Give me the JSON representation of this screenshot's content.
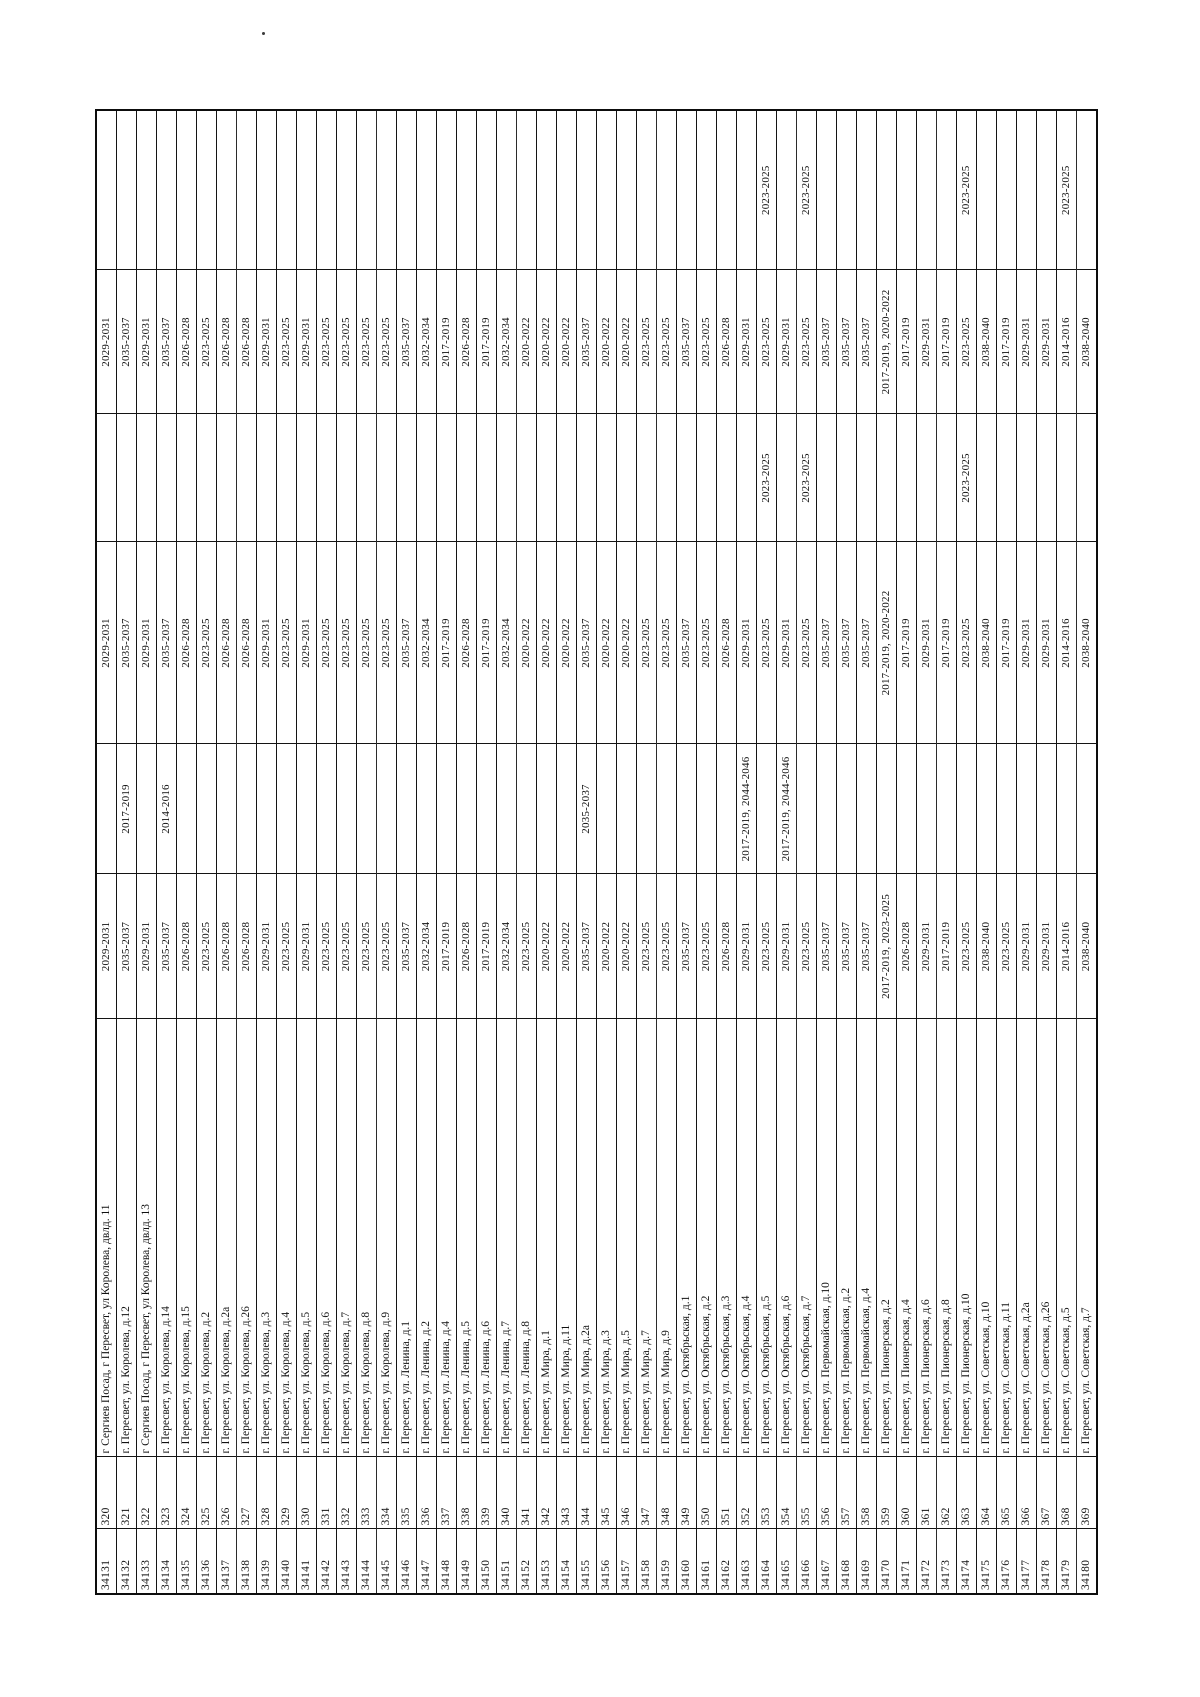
{
  "page": {
    "background": "#ffffff",
    "ink_color": "#111111",
    "artifact_dot": ".",
    "orientation_note_rows": "320-369",
    "orientation_note_ids": "34131-34180"
  },
  "table": {
    "orientation": "rotated-90-counterclockwise",
    "column_keys": [
      "id",
      "num",
      "address",
      "period_1",
      "period_2",
      "period_3",
      "period_4",
      "period_5",
      "period_6"
    ],
    "rows": [
      {
        "id": "34131",
        "num": "320",
        "address": "г Сергиев Посад, г Пересвет, ул Королева, двлд. 11",
        "periods": [
          "2029-2031",
          "",
          "2029-2031",
          "",
          "2029-2031",
          ""
        ]
      },
      {
        "id": "34132",
        "num": "321",
        "address": "г. Пересвет, ул. Королева, д.12",
        "periods": [
          "2035-2037",
          "2017-2019",
          "2035-2037",
          "",
          "2035-2037",
          ""
        ]
      },
      {
        "id": "34133",
        "num": "322",
        "address": "г Сергиев Посад, г Пересвет, ул Королева, двлд. 13",
        "periods": [
          "2029-2031",
          "",
          "2029-2031",
          "",
          "2029-2031",
          ""
        ]
      },
      {
        "id": "34134",
        "num": "323",
        "address": "г. Пересвет, ул. Королева, д.14",
        "periods": [
          "2035-2037",
          "2014-2016",
          "2035-2037",
          "",
          "2035-2037",
          ""
        ]
      },
      {
        "id": "34135",
        "num": "324",
        "address": "г. Пересвет, ул. Королева, д.15",
        "periods": [
          "2026-2028",
          "",
          "2026-2028",
          "",
          "2026-2028",
          ""
        ]
      },
      {
        "id": "34136",
        "num": "325",
        "address": "г. Пересвет, ул. Королева, д.2",
        "periods": [
          "2023-2025",
          "",
          "2023-2025",
          "",
          "2023-2025",
          ""
        ]
      },
      {
        "id": "34137",
        "num": "326",
        "address": "г. Пересвет, ул. Королева, д.2а",
        "periods": [
          "2026-2028",
          "",
          "2026-2028",
          "",
          "2026-2028",
          ""
        ]
      },
      {
        "id": "34138",
        "num": "327",
        "address": "г. Пересвет, ул. Королева, д.26",
        "periods": [
          "2026-2028",
          "",
          "2026-2028",
          "",
          "2026-2028",
          ""
        ]
      },
      {
        "id": "34139",
        "num": "328",
        "address": "г. Пересвет, ул. Королева, д.3",
        "periods": [
          "2029-2031",
          "",
          "2029-2031",
          "",
          "2029-2031",
          ""
        ]
      },
      {
        "id": "34140",
        "num": "329",
        "address": "г. Пересвет, ул. Королева, д.4",
        "periods": [
          "2023-2025",
          "",
          "2023-2025",
          "",
          "2023-2025",
          ""
        ]
      },
      {
        "id": "34141",
        "num": "330",
        "address": "г. Пересвет, ул. Королева, д.5",
        "periods": [
          "2029-2031",
          "",
          "2029-2031",
          "",
          "2029-2031",
          ""
        ]
      },
      {
        "id": "34142",
        "num": "331",
        "address": "г. Пересвет, ул. Королева, д.6",
        "periods": [
          "2023-2025",
          "",
          "2023-2025",
          "",
          "2023-2025",
          ""
        ]
      },
      {
        "id": "34143",
        "num": "332",
        "address": "г. Пересвет, ул. Королева, д.7",
        "periods": [
          "2023-2025",
          "",
          "2023-2025",
          "",
          "2023-2025",
          ""
        ]
      },
      {
        "id": "34144",
        "num": "333",
        "address": "г. Пересвет, ул. Королева, д.8",
        "periods": [
          "2023-2025",
          "",
          "2023-2025",
          "",
          "2023-2025",
          ""
        ]
      },
      {
        "id": "34145",
        "num": "334",
        "address": "г. Пересвет, ул. Королева, д.9",
        "periods": [
          "2023-2025",
          "",
          "2023-2025",
          "",
          "2023-2025",
          ""
        ]
      },
      {
        "id": "34146",
        "num": "335",
        "address": "г. Пересвет, ул. Ленина, д.1",
        "periods": [
          "2035-2037",
          "",
          "2035-2037",
          "",
          "2035-2037",
          ""
        ]
      },
      {
        "id": "34147",
        "num": "336",
        "address": "г. Пересвет, ул. Ленина, д.2",
        "periods": [
          "2032-2034",
          "",
          "2032-2034",
          "",
          "2032-2034",
          ""
        ]
      },
      {
        "id": "34148",
        "num": "337",
        "address": "г. Пересвет, ул. Ленина, д.4",
        "periods": [
          "2017-2019",
          "",
          "2017-2019",
          "",
          "2017-2019",
          ""
        ]
      },
      {
        "id": "34149",
        "num": "338",
        "address": "г. Пересвет, ул. Ленина, д.5",
        "periods": [
          "2026-2028",
          "",
          "2026-2028",
          "",
          "2026-2028",
          ""
        ]
      },
      {
        "id": "34150",
        "num": "339",
        "address": "г. Пересвет, ул. Ленина, д.6",
        "periods": [
          "2017-2019",
          "",
          "2017-2019",
          "",
          "2017-2019",
          ""
        ]
      },
      {
        "id": "34151",
        "num": "340",
        "address": "г. Пересвет, ул. Ленина, д.7",
        "periods": [
          "2032-2034",
          "",
          "2032-2034",
          "",
          "2032-2034",
          ""
        ]
      },
      {
        "id": "34152",
        "num": "341",
        "address": "г. Пересвет, ул. Ленина, д.8",
        "periods": [
          "2023-2025",
          "",
          "2020-2022",
          "",
          "2020-2022",
          ""
        ]
      },
      {
        "id": "34153",
        "num": "342",
        "address": "г. Пересвет, ул. Мира, д.1",
        "periods": [
          "2020-2022",
          "",
          "2020-2022",
          "",
          "2020-2022",
          ""
        ]
      },
      {
        "id": "34154",
        "num": "343",
        "address": "г. Пересвет, ул. Мира, д.11",
        "periods": [
          "2020-2022",
          "",
          "2020-2022",
          "",
          "2020-2022",
          ""
        ]
      },
      {
        "id": "34155",
        "num": "344",
        "address": "г. Пересвет, ул. Мира, д.2а",
        "periods": [
          "2035-2037",
          "2035-2037",
          "2035-2037",
          "",
          "2035-2037",
          ""
        ]
      },
      {
        "id": "34156",
        "num": "345",
        "address": "г. Пересвет, ул. Мира, д.3",
        "periods": [
          "2020-2022",
          "",
          "2020-2022",
          "",
          "2020-2022",
          ""
        ]
      },
      {
        "id": "34157",
        "num": "346",
        "address": "г. Пересвет, ул. Мира, д.5",
        "periods": [
          "2020-2022",
          "",
          "2020-2022",
          "",
          "2020-2022",
          ""
        ]
      },
      {
        "id": "34158",
        "num": "347",
        "address": "г. Пересвет, ул. Мира, д.7",
        "periods": [
          "2023-2025",
          "",
          "2023-2025",
          "",
          "2023-2025",
          ""
        ]
      },
      {
        "id": "34159",
        "num": "348",
        "address": "г. Пересвет, ул. Мира, д.9",
        "periods": [
          "2023-2025",
          "",
          "2023-2025",
          "",
          "2023-2025",
          ""
        ]
      },
      {
        "id": "34160",
        "num": "349",
        "address": "г. Пересвет, ул. Октябрьская, д.1",
        "periods": [
          "2035-2037",
          "",
          "2035-2037",
          "",
          "2035-2037",
          ""
        ]
      },
      {
        "id": "34161",
        "num": "350",
        "address": "г. Пересвет, ул. Октябрьская, д.2",
        "periods": [
          "2023-2025",
          "",
          "2023-2025",
          "",
          "2023-2025",
          ""
        ]
      },
      {
        "id": "34162",
        "num": "351",
        "address": "г. Пересвет, ул. Октябрьская, д.3",
        "periods": [
          "2026-2028",
          "",
          "2026-2028",
          "",
          "2026-2028",
          ""
        ]
      },
      {
        "id": "34163",
        "num": "352",
        "address": "г. Пересвет, ул. Октябрьская, д.4",
        "periods": [
          "2029-2031",
          "2017-2019, 2044-2046",
          "2029-2031",
          "",
          "2029-2031",
          ""
        ]
      },
      {
        "id": "34164",
        "num": "353",
        "address": "г. Пересвет, ул. Октябрьская, д.5",
        "periods": [
          "2023-2025",
          "",
          "2023-2025",
          "2023-2025",
          "2023-2025",
          "2023-2025"
        ]
      },
      {
        "id": "34165",
        "num": "354",
        "address": "г. Пересвет, ул. Октябрьская, д.6",
        "periods": [
          "2029-2031",
          "2017-2019, 2044-2046",
          "2029-2031",
          "",
          "2029-2031",
          ""
        ]
      },
      {
        "id": "34166",
        "num": "355",
        "address": "г. Пересвет, ул. Октябрьская, д.7",
        "periods": [
          "2023-2025",
          "",
          "2023-2025",
          "2023-2025",
          "2023-2025",
          "2023-2025"
        ]
      },
      {
        "id": "34167",
        "num": "356",
        "address": "г. Пересвет, ул. Первомайская, д.10",
        "periods": [
          "2035-2037",
          "",
          "2035-2037",
          "",
          "2035-2037",
          ""
        ]
      },
      {
        "id": "34168",
        "num": "357",
        "address": "г. Пересвет, ул. Первомайская, д.2",
        "periods": [
          "2035-2037",
          "",
          "2035-2037",
          "",
          "2035-2037",
          ""
        ]
      },
      {
        "id": "34169",
        "num": "358",
        "address": "г. Пересвет, ул. Первомайская, д.4",
        "periods": [
          "2035-2037",
          "",
          "2035-2037",
          "",
          "2035-2037",
          ""
        ]
      },
      {
        "id": "34170",
        "num": "359",
        "address": "г. Пересвет, ул. Пионерская, д.2",
        "periods": [
          "2017-2019, 2023-2025",
          "",
          "2017-2019, 2020-2022",
          "",
          "2017-2019, 2020-2022",
          ""
        ]
      },
      {
        "id": "34171",
        "num": "360",
        "address": "г. Пересвет, ул. Пионерская, д.4",
        "periods": [
          "2026-2028",
          "",
          "2017-2019",
          "",
          "2017-2019",
          ""
        ]
      },
      {
        "id": "34172",
        "num": "361",
        "address": "г. Пересвет, ул. Пионерская, д.6",
        "periods": [
          "2029-2031",
          "",
          "2029-2031",
          "",
          "2029-2031",
          ""
        ]
      },
      {
        "id": "34173",
        "num": "362",
        "address": "г. Пересвет, ул. Пионерская, д.8",
        "periods": [
          "2017-2019",
          "",
          "2017-2019",
          "",
          "2017-2019",
          ""
        ]
      },
      {
        "id": "34174",
        "num": "363",
        "address": "г. Пересвет, ул. Пионерская, д.10",
        "periods": [
          "2023-2025",
          "",
          "2023-2025",
          "2023-2025",
          "2023-2025",
          "2023-2025"
        ]
      },
      {
        "id": "34175",
        "num": "364",
        "address": "г. Пересвет, ул. Советская, д.10",
        "periods": [
          "2038-2040",
          "",
          "2038-2040",
          "",
          "2038-2040",
          ""
        ]
      },
      {
        "id": "34176",
        "num": "365",
        "address": "г. Пересвет, ул. Советская, д.11",
        "periods": [
          "2023-2025",
          "",
          "2017-2019",
          "",
          "2017-2019",
          ""
        ]
      },
      {
        "id": "34177",
        "num": "366",
        "address": "г. Пересвет, ул. Советская, д.2а",
        "periods": [
          "2029-2031",
          "",
          "2029-2031",
          "",
          "2029-2031",
          ""
        ]
      },
      {
        "id": "34178",
        "num": "367",
        "address": "г. Пересвет, ул. Советская, д.26",
        "periods": [
          "2029-2031",
          "",
          "2029-2031",
          "",
          "2029-2031",
          ""
        ]
      },
      {
        "id": "34179",
        "num": "368",
        "address": "г. Пересвет, ул. Советская, д.5",
        "periods": [
          "2014-2016",
          "",
          "2014-2016",
          "",
          "2014-2016",
          "2023-2025"
        ]
      },
      {
        "id": "34180",
        "num": "369",
        "address": "г. Пересвет, ул. Советская, д.7",
        "periods": [
          "2038-2040",
          "",
          "2038-2040",
          "",
          "2038-2040",
          ""
        ]
      }
    ]
  }
}
